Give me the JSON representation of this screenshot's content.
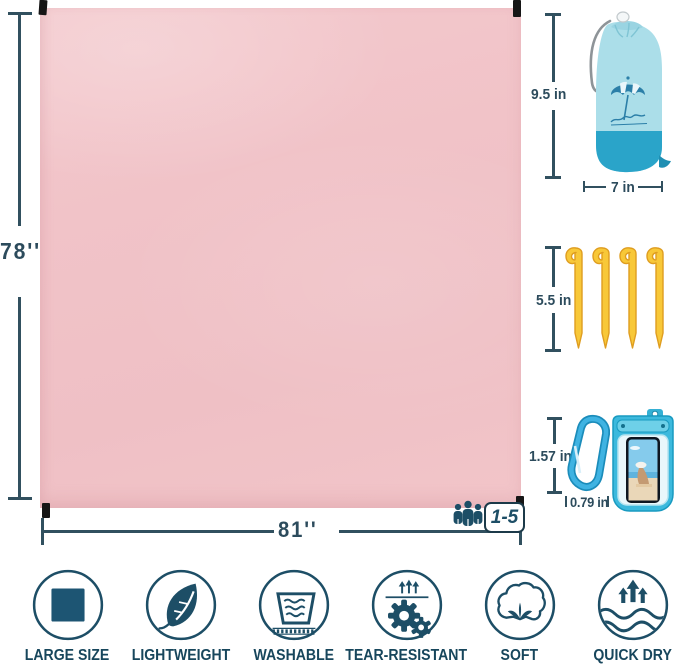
{
  "product_name": "picnic blanket infographic",
  "blanket": {
    "height_label": "78''",
    "width_label": "81''",
    "capacity_label": "1-5",
    "color": "#f1c3c8"
  },
  "accessories": {
    "bag": {
      "name": "drawstring storage bag",
      "height_label": "9.5 in",
      "width_label": "7 in",
      "logo_icon": "beach-umbrella-logo",
      "body_color": "#abdee9",
      "base_color": "#2aa4c9"
    },
    "stakes": {
      "name": "tent stakes",
      "length_label": "5.5 in",
      "count": 4,
      "color": "#f8c838"
    },
    "carabiner": {
      "name": "carabiner clip",
      "height_label": "1.57 in",
      "width_label": "0.79 in",
      "color": "#3fb3e2"
    },
    "phone_pouch": {
      "name": "waterproof phone pouch",
      "color": "#3cb9dd"
    }
  },
  "features": [
    {
      "icon": "square-icon",
      "label": "LARGE SIZE"
    },
    {
      "icon": "leaf-icon",
      "label": "LIGHTWEIGHT"
    },
    {
      "icon": "wash-basin-icon",
      "label": "WASHABLE"
    },
    {
      "icon": "gears-icon",
      "label": "TEAR-RESISTANT"
    },
    {
      "icon": "cotton-icon",
      "label": "SOFT"
    },
    {
      "icon": "waves-arrows-icon",
      "label": "QUICK DRY"
    }
  ],
  "colors": {
    "accent": "#31505f",
    "icon_teal": "#1d4e66",
    "blanket_pink": "#f1c3c8"
  }
}
